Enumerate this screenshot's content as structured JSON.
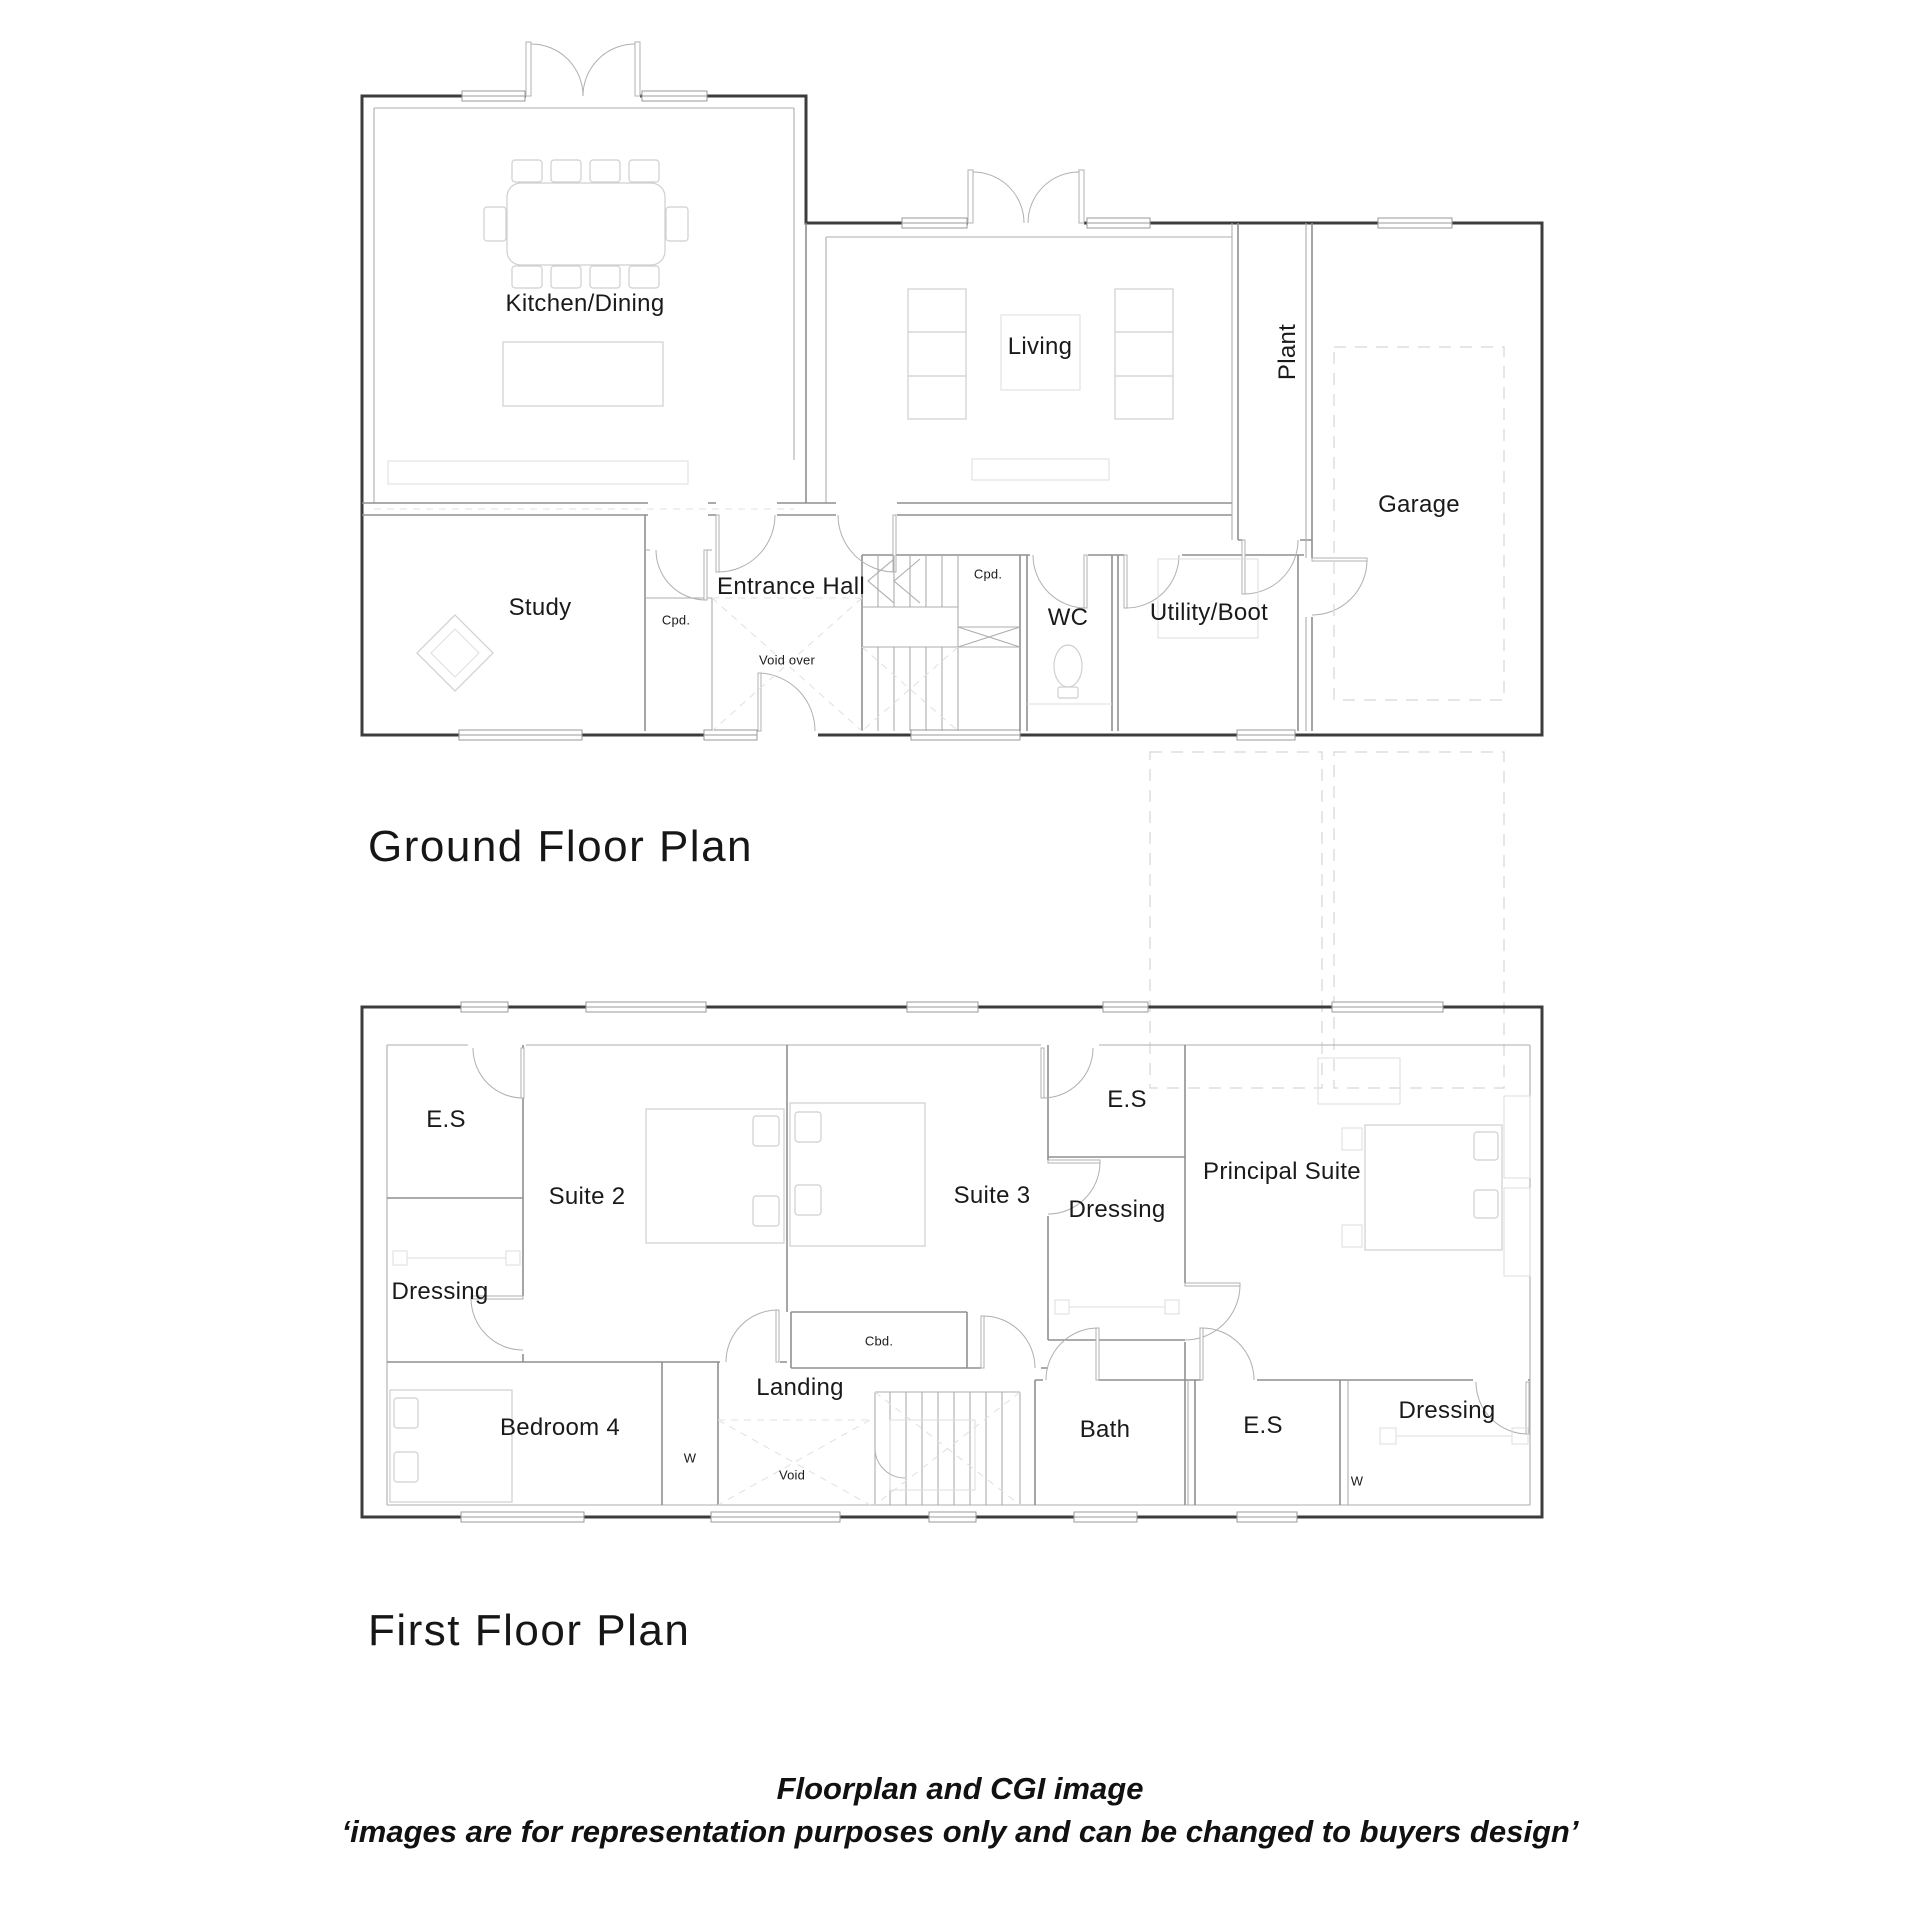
{
  "ground_floor": {
    "title": "Ground Floor Plan",
    "rooms": {
      "kitchen_dining": "Kitchen/Dining",
      "living": "Living",
      "plant": "Plant",
      "garage": "Garage",
      "study": "Study",
      "entrance_hall": "Entrance Hall",
      "cpd_study": "Cpd.",
      "cpd_stairs": "Cpd.",
      "void_over": "Void over",
      "wc": "WC",
      "utility_boot": "Utility/Boot"
    }
  },
  "first_floor": {
    "title": "First Floor Plan",
    "rooms": {
      "es_suite2": "E.S",
      "dressing_suite2": "Dressing",
      "suite2": "Suite 2",
      "suite3": "Suite 3",
      "es_suite3": "E.S",
      "dressing_suite3": "Dressing",
      "principal_suite": "Principal Suite",
      "cbd": "Cbd.",
      "landing": "Landing",
      "bedroom4": "Bedroom 4",
      "w_bedroom4": "W",
      "void": "Void",
      "bath": "Bath",
      "es_bath": "E.S",
      "dressing_principal": "Dressing",
      "w_principal": "W"
    }
  },
  "footer": {
    "line1": "Floorplan and CGI image",
    "line2": "‘images are for representation purposes only and can be changed to buyers design’"
  },
  "colors": {
    "background": "#ffffff",
    "outer_wall": "#3c3c3c",
    "partition": "#8f8f8f",
    "furniture": "#cfcfcf",
    "dashed_outline": "#d8d8d8",
    "text": "#1a1a1a"
  }
}
